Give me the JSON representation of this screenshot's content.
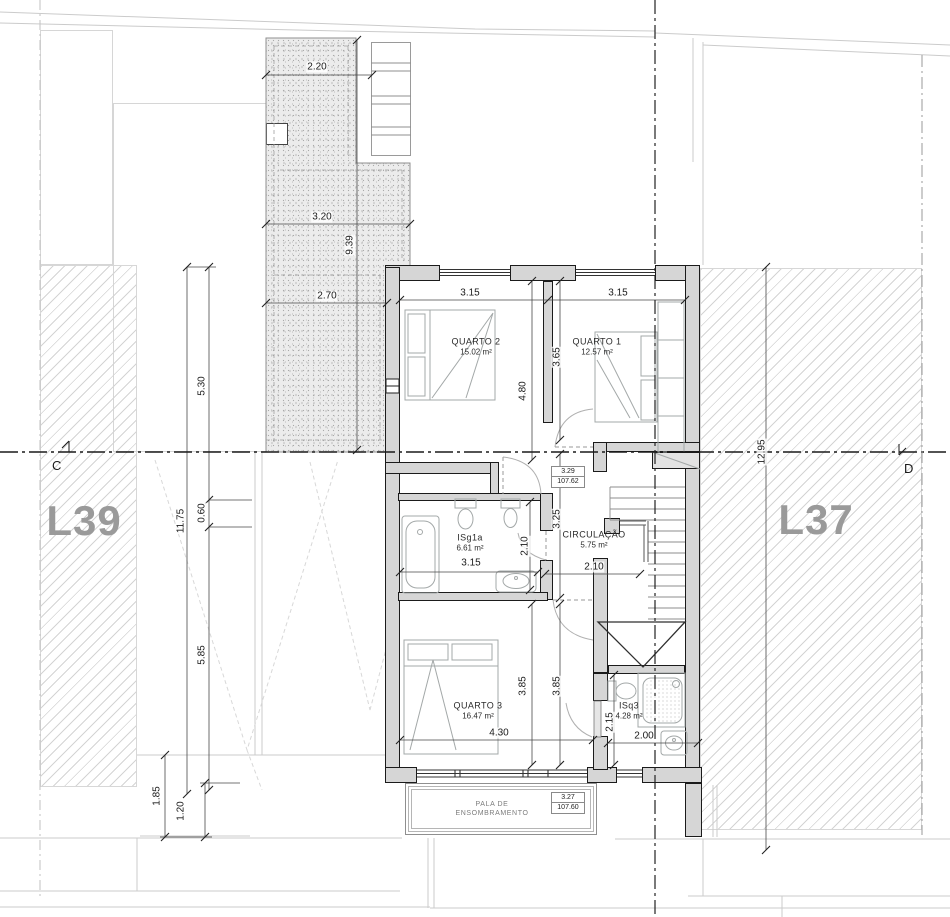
{
  "site": {
    "lot_left": "L39",
    "lot_right": "L37",
    "section_left": "C",
    "section_right": "D"
  },
  "rooms": [
    {
      "id": "quarto2",
      "name": "QUARTO 2",
      "area": "15.02 m²",
      "x": 476,
      "y": 347
    },
    {
      "id": "quarto1",
      "name": "QUARTO 1",
      "area": "12.57 m²",
      "x": 597,
      "y": 347
    },
    {
      "id": "circulacao",
      "name": "CIRCULAÇÃO",
      "area": "5.75 m²",
      "x": 594,
      "y": 540
    },
    {
      "id": "isg1a",
      "name": "ISg1a",
      "area": "6.61 m²",
      "x": 470,
      "y": 543
    },
    {
      "id": "quarto3",
      "name": "QUARTO 3",
      "area": "16.47 m²",
      "x": 478,
      "y": 711
    },
    {
      "id": "isq3",
      "name": "ISq3",
      "area": "4.28 m²",
      "x": 629,
      "y": 711
    }
  ],
  "annotations": {
    "canopy_line1": "PALA DE",
    "canopy_line2": "ENSOMBRAMENTO"
  },
  "elevation_markers": [
    {
      "level": "3.29",
      "datum": "107.62",
      "x": 551,
      "y": 466
    },
    {
      "level": "3.27",
      "datum": "107.60",
      "x": 551,
      "y": 792
    }
  ],
  "dimensions": [
    {
      "text": "2.20",
      "x": 317,
      "y": 67,
      "r": 0
    },
    {
      "text": "3.20",
      "x": 322,
      "y": 217,
      "r": 0
    },
    {
      "text": "9.39",
      "x": 350,
      "y": 245,
      "r": 1
    },
    {
      "text": "2.70",
      "x": 327,
      "y": 296,
      "r": 0
    },
    {
      "text": "5.30",
      "x": 202,
      "y": 386,
      "r": 1
    },
    {
      "text": "11.75",
      "x": 181,
      "y": 521,
      "r": 1
    },
    {
      "text": "0.60",
      "x": 202,
      "y": 513,
      "r": 1
    },
    {
      "text": "5.85",
      "x": 202,
      "y": 655,
      "r": 1
    },
    {
      "text": "1.85",
      "x": 157,
      "y": 796,
      "r": 1
    },
    {
      "text": "1.20",
      "x": 181,
      "y": 811,
      "r": 1
    },
    {
      "text": "3.15",
      "x": 470,
      "y": 293,
      "r": 0
    },
    {
      "text": "3.15",
      "x": 618,
      "y": 293,
      "r": 0
    },
    {
      "text": "4.80",
      "x": 523,
      "y": 391,
      "r": 1
    },
    {
      "text": "3.65",
      "x": 557,
      "y": 357,
      "r": 1
    },
    {
      "text": "3.25",
      "x": 557,
      "y": 519,
      "r": 1
    },
    {
      "text": "2.10",
      "x": 525,
      "y": 546,
      "r": 1
    },
    {
      "text": "3.15",
      "x": 471,
      "y": 563,
      "r": 0
    },
    {
      "text": "2.10",
      "x": 594,
      "y": 567,
      "r": 0
    },
    {
      "text": "3.85",
      "x": 523,
      "y": 686,
      "r": 1
    },
    {
      "text": "3.85",
      "x": 557,
      "y": 686,
      "r": 1
    },
    {
      "text": "4.30",
      "x": 499,
      "y": 733,
      "r": 0
    },
    {
      "text": "2.15",
      "x": 610,
      "y": 722,
      "r": 1
    },
    {
      "text": "2.00",
      "x": 644,
      "y": 736,
      "r": 0
    },
    {
      "text": "12.95",
      "x": 762,
      "y": 452,
      "r": 1
    }
  ],
  "colors": {
    "wall_fill": "#d6d6d6",
    "wall_line": "#1b1b1b",
    "hatch_line": "#d4d4d4",
    "hedge_light": "#b5cd55",
    "hedge_dark": "#42511d",
    "centerline": "#1a1a1a",
    "lot_label": "#9a9a9a"
  }
}
